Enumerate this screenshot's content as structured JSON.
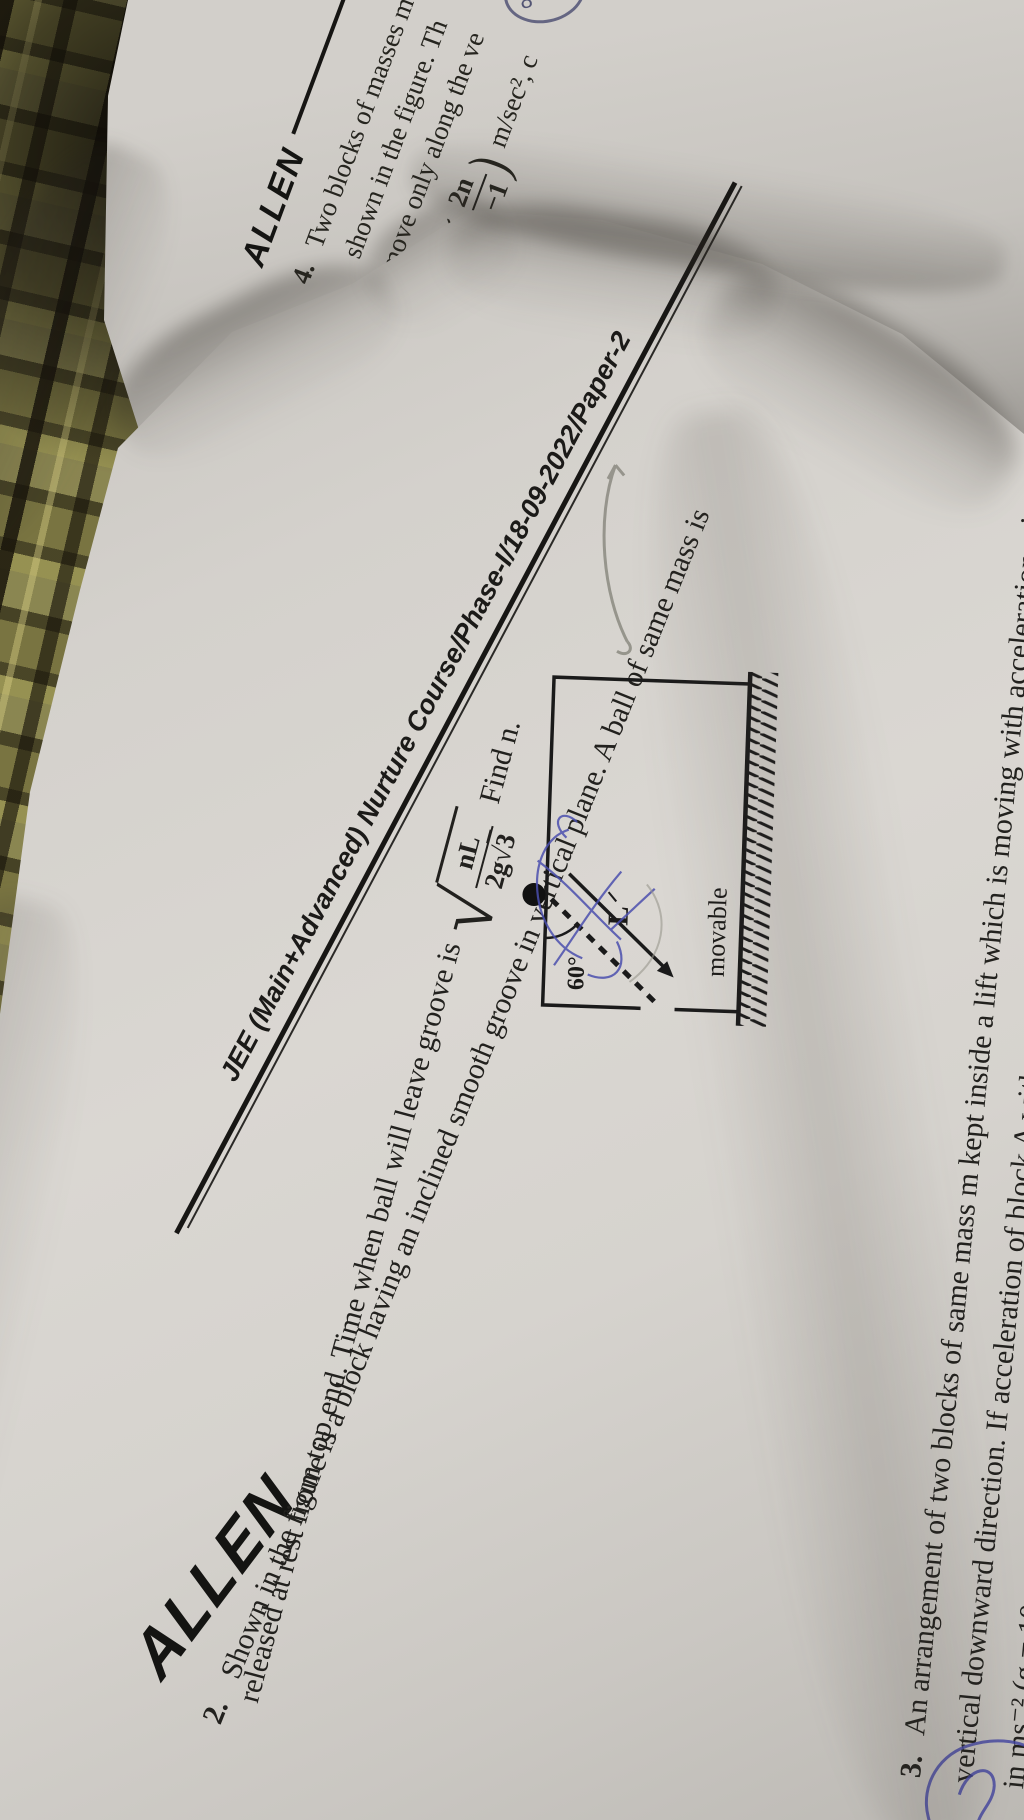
{
  "brand": {
    "logo": "ALLEN"
  },
  "header": {
    "title": "JEE (Main+Advanced) Nurture Course/Phase-I/18-09-2022/Paper-2"
  },
  "q2": {
    "number": "2.",
    "line1": "Shown in the figure is a block having an inclined smooth groove in vertical plane. A ball of same mass is",
    "line2_pre": "released at rest from top end. Time when ball will leave groove is",
    "line2_post": "Find n.",
    "formula": {
      "radical": "√",
      "num": "nL",
      "den_coeff": "2g",
      "den_radical": "√",
      "den_radicand": "3"
    },
    "figure": {
      "angle": "60°",
      "length": "L",
      "label": "movable"
    }
  },
  "q3": {
    "number": "3.",
    "line1": "An arrangement of two blocks of same mass m kept inside a lift which is moving with acceleration a in",
    "line2": "vertical downward direction. If acceleration of block A with respect to earth is minimum, find the value of",
    "line3": "in ms⁻² (g = 10 ms⁻²)"
  },
  "q4": {
    "brand": "ALLEN",
    "number": "4.",
    "line1": "Two blocks of masses m",
    "line2": "shown in the figure. Th",
    "line3": "move only along the ve",
    "formula": {
      "open": "(",
      "num": "2n",
      "den": "n−1",
      "close": ")",
      "unit": "m/sec², c"
    },
    "annotation": "8"
  },
  "colors": {
    "paper": "#d6d3ce",
    "ink": "#22211e",
    "pen_blue": "#4b4fae",
    "pencil": "#8b8a80",
    "fabric": "#6b673c"
  }
}
